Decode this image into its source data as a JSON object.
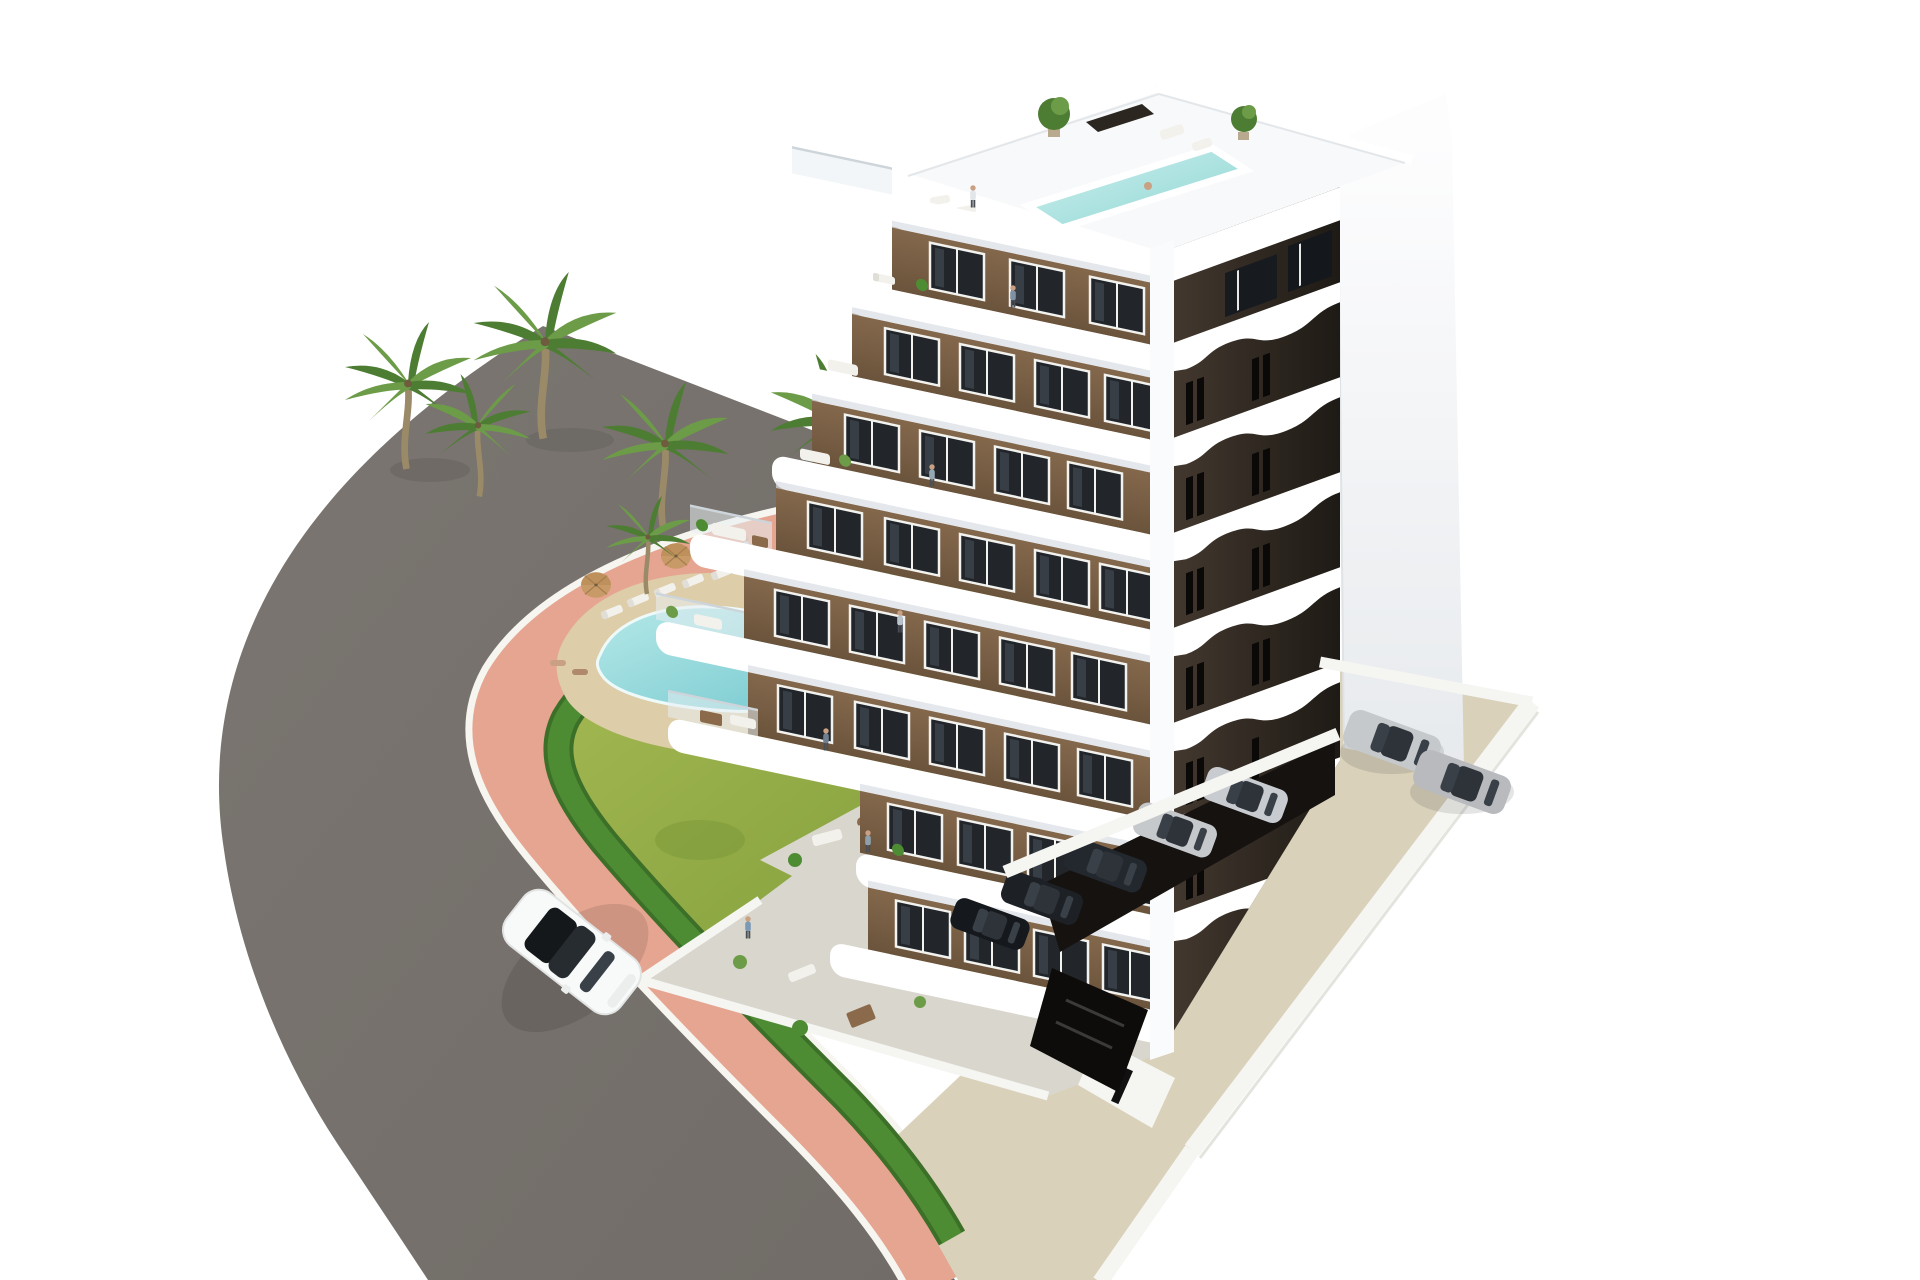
{
  "scene": {
    "description": "Aerial 3D architectural rendering of a modern eight-storey white apartment building with brown facade panels, curved white balcony bands, a rooftop terrace with plunge pool, a landscaped garden with a free-form swimming pool and palm trees, a curved asphalt road with a pink sidewalk, a white car driving on the road, and a parking court with silver and dark cars",
    "labels": {
      "road": "curved asphalt road",
      "sidewalk": "pink pedestrian sidewalk with white curbs",
      "garden": "landscaped lawn garden",
      "hedge": "trimmed green hedge along the sidewalk",
      "gravel": "gravel planting strip with shrubs",
      "pool": "free-form turquoise swimming pool",
      "pool_deck": "sand-coloured pool deck with sun loungers and parasols",
      "palms": "palm trees",
      "building": "eight-storey apartment building",
      "left_facade": "south-west facade with brown walls and white balconies",
      "right_facade": "dark brown facade with curved white balcony bands",
      "gable": "tall white end wall",
      "roof": "roof terrace with plunge pool, plants and lounge furniture",
      "ground_terrace": "ground-floor concrete terrace with outdoor furniture",
      "parking": "beige parking court with white perimeter walls",
      "covered_parking": "covered parking bay under the building",
      "white_car": "white car driving on the road",
      "parked_cars": "parked silver and dark cars"
    }
  },
  "counts": {
    "building_floors": 8,
    "garden_palm_trees": 6,
    "roof_trees": 2,
    "pool_loungers": 5,
    "pool_umbrellas": 2,
    "cars_on_road": 1,
    "parked_cars_open": 2,
    "parked_cars_covered": 5,
    "people_visible": 12
  },
  "palette": {
    "bg": "#ffffff",
    "road": "#716c67",
    "road_b": "#7b7671",
    "sidewalk": "#e5a591",
    "curb": "#f7f5f0",
    "gravel": "#cfcac0",
    "lawn_a": "#a9bc55",
    "lawn_b": "#7e9c3a",
    "hedge": "#4e8c34",
    "hedge_dark": "#3c6f27",
    "pool_deck": "#ddcda9",
    "pool_a": "#b5e8e8",
    "pool_b": "#76c9cf",
    "roofpool_a": "#cdf0ee",
    "roofpool_b": "#8fd6d4",
    "palm_trunk": "#9b8a68",
    "frond_a": "#4d7d33",
    "frond_b": "#6d9c48",
    "brown_a": "#84684c",
    "brown_b": "#6b543c",
    "dark_a": "#453a30",
    "dark_b": "#1e1a15",
    "slab": "#ffffff",
    "slab_shadow": "#d8dde2",
    "glass": "#22262b",
    "gable_a": "#fdfdfe",
    "gable_b": "#e7eaed",
    "roof": "#f8f9fa",
    "apron": "#d9d1ba",
    "recess": "#151210",
    "wall_white": "#f5f5f2",
    "terrace": "#d9d6cd",
    "car_white": "#f8f9f9",
    "car_silver": "#c6c9cc",
    "car_dark": "#23272e",
    "umbrella": "#c89a68",
    "furn_white": "#f2f1ec",
    "furn_brown": "#8a6a4a",
    "skin": "#c9a083"
  }
}
